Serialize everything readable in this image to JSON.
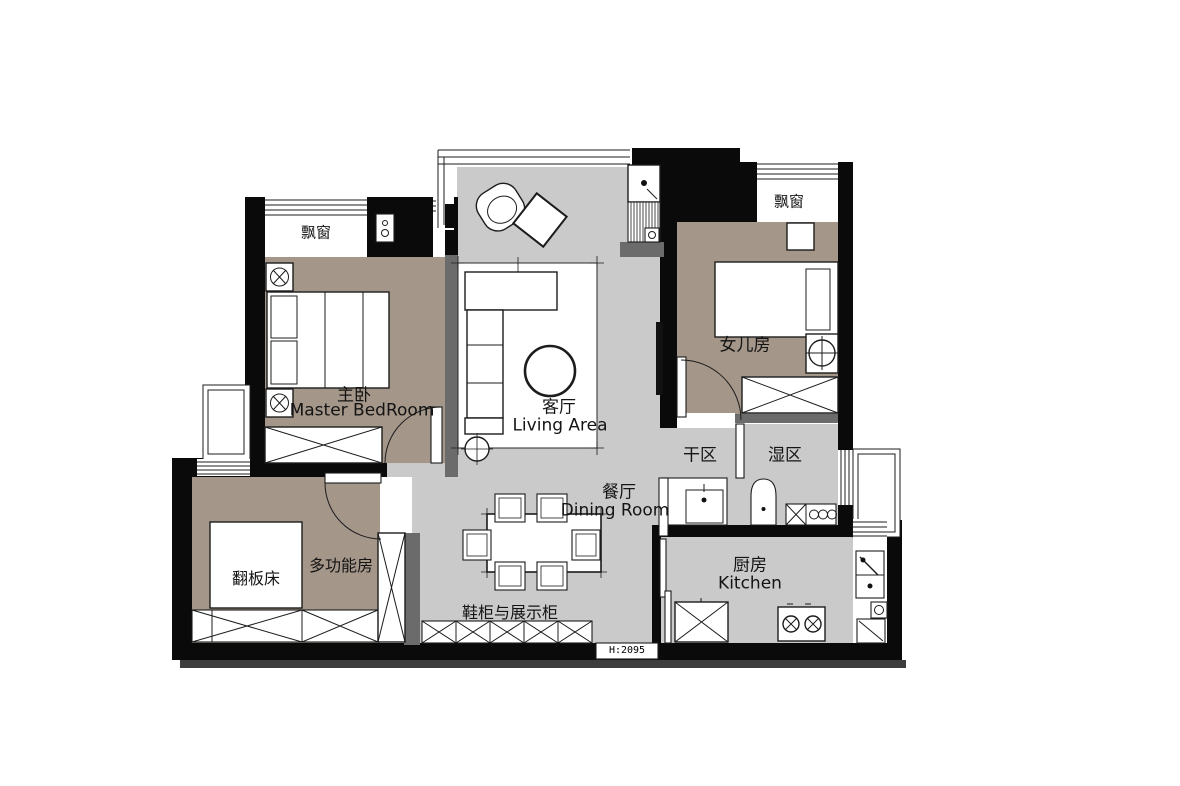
{
  "type": "apartment-floor-plan",
  "rooms": {
    "master_bedroom": {
      "zh": "主卧",
      "en": "Master BedRoom"
    },
    "living_area": {
      "zh": "客厅",
      "en": "Living Area"
    },
    "dining_room": {
      "zh": "餐厅",
      "en": "Dining Room"
    },
    "kitchen": {
      "zh": "厨房",
      "en": "Kitchen"
    },
    "daughter_room": {
      "zh": "女儿房"
    },
    "multi_function_room": {
      "zh": "多功能房"
    },
    "dry_area": {
      "zh": "干区"
    },
    "wet_area": {
      "zh": "湿区"
    }
  },
  "features": {
    "bay_window_left": "飘窗",
    "bay_window_right": "飘窗",
    "flip_bed": "翻板床",
    "shoe_display_cabinet": "鞋柜与展示柜",
    "ceiling_height": "H:2095"
  },
  "colors": {
    "wall": "#0a0a0a",
    "floor_public": "#cacaca",
    "floor_bedroom": "#a49689",
    "sill_strip": "#6b6b6b",
    "line": "#1c1c1c",
    "background": "#ffffff",
    "shadow": "#3d3d3d"
  }
}
